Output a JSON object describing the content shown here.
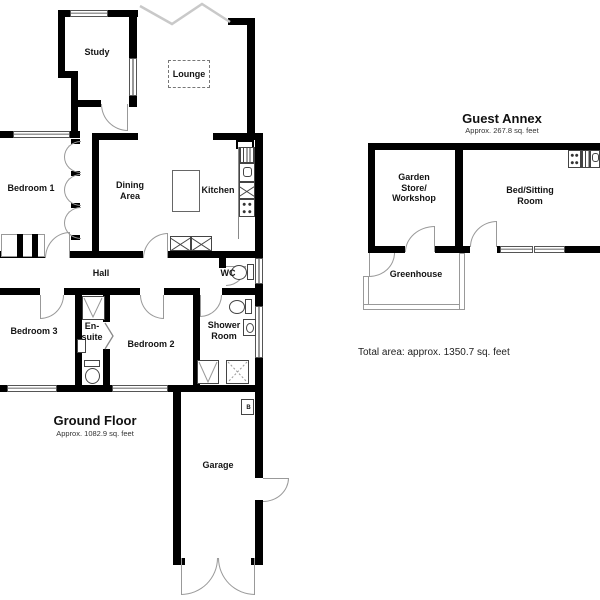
{
  "ground_floor": {
    "title": "Ground Floor",
    "area_label": "Approx. 1082.9 sq. feet",
    "rooms": {
      "study": "Study",
      "lounge": "Lounge",
      "bedroom1": "Bedroom 1",
      "dining": "Dining Area",
      "kitchen": "Kitchen",
      "hall": "Hall",
      "wc": "WC",
      "bedroom3": "Bedroom 3",
      "ensuite": "En-suite",
      "bedroom2": "Bedroom 2",
      "shower": "Shower Room",
      "garage": "Garage",
      "boiler": "B"
    }
  },
  "guest_annex": {
    "title": "Guest Annex",
    "area_label": "Approx. 267.8 sq. feet",
    "rooms": {
      "garden_store": "Garden Store/ Workshop",
      "bed_sitting": "Bed/Sitting Room",
      "greenhouse": "Greenhouse"
    }
  },
  "footer": {
    "total_area": "Total area: approx. 1350.7 sq. feet"
  },
  "colors": {
    "wall": "#000000",
    "door_arc": "#999999",
    "break_line": "#c9c9c9"
  }
}
